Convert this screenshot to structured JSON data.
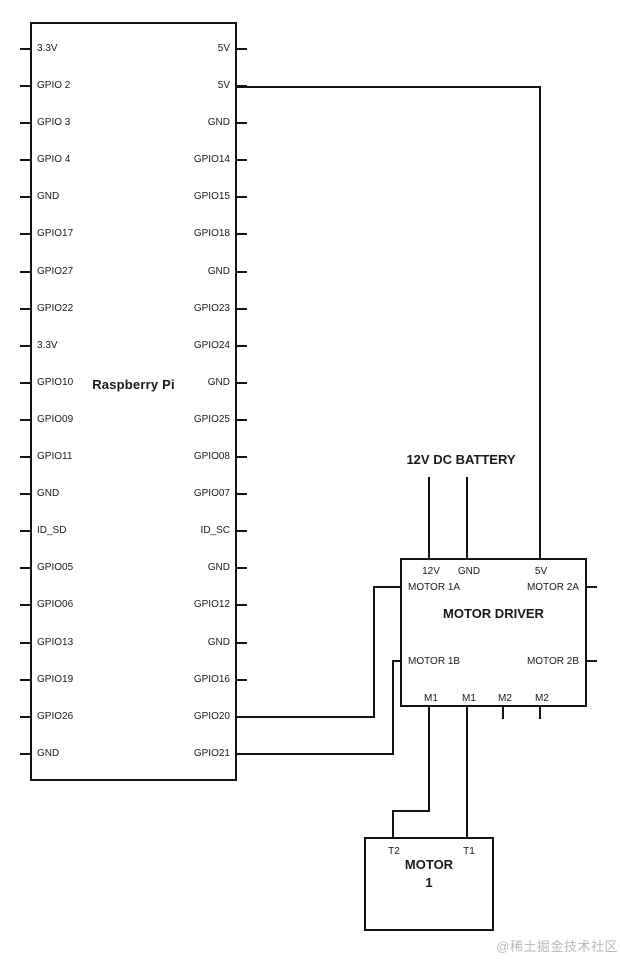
{
  "colors": {
    "background": "#ffffff",
    "line": "#141414",
    "text": "#1a1a1a",
    "watermark": "#b9b9b9"
  },
  "raspberry_pi": {
    "title": "Raspberry Pi",
    "pins": [
      {
        "left": "3.3V",
        "right": "5V"
      },
      {
        "left": "GPIO 2",
        "right": "5V"
      },
      {
        "left": "GPIO 3",
        "right": "GND"
      },
      {
        "left": "GPIO 4",
        "right": "GPIO14"
      },
      {
        "left": "GND",
        "right": "GPIO15"
      },
      {
        "left": "GPIO17",
        "right": "GPIO18"
      },
      {
        "left": "GPIO27",
        "right": "GND"
      },
      {
        "left": "GPIO22",
        "right": "GPIO23"
      },
      {
        "left": "3.3V",
        "right": "GPIO24"
      },
      {
        "left": "GPIO10",
        "right": "GND"
      },
      {
        "left": "GPIO09",
        "right": "GPIO25"
      },
      {
        "left": "GPIO11",
        "right": "GPIO08"
      },
      {
        "left": "GND",
        "right": "GPIO07"
      },
      {
        "left": "ID_SD",
        "right": "ID_SC"
      },
      {
        "left": "GPIO05",
        "right": "GND"
      },
      {
        "left": "GPIO06",
        "right": "GPIO12"
      },
      {
        "left": "GPIO13",
        "right": "GND"
      },
      {
        "left": "GPIO19",
        "right": "GPIO16"
      },
      {
        "left": "GPIO26",
        "right": "GPIO20"
      },
      {
        "left": "GND",
        "right": "GPIO21"
      }
    ]
  },
  "battery": {
    "label": "12V DC BATTERY"
  },
  "motor_driver": {
    "title": "MOTOR DRIVER",
    "top_pins": [
      "12V",
      "GND",
      "5V"
    ],
    "left_pins": [
      "MOTOR 1A",
      "MOTOR 1B"
    ],
    "right_pins": [
      "MOTOR 2A",
      "MOTOR 2B"
    ],
    "bottom_pins": [
      "M1",
      "M1",
      "M2",
      "M2"
    ]
  },
  "motor": {
    "title": "MOTOR",
    "number": "1",
    "left_terminal": "T2",
    "right_terminal": "T1"
  },
  "watermark": "@稀土掘金技术社区"
}
